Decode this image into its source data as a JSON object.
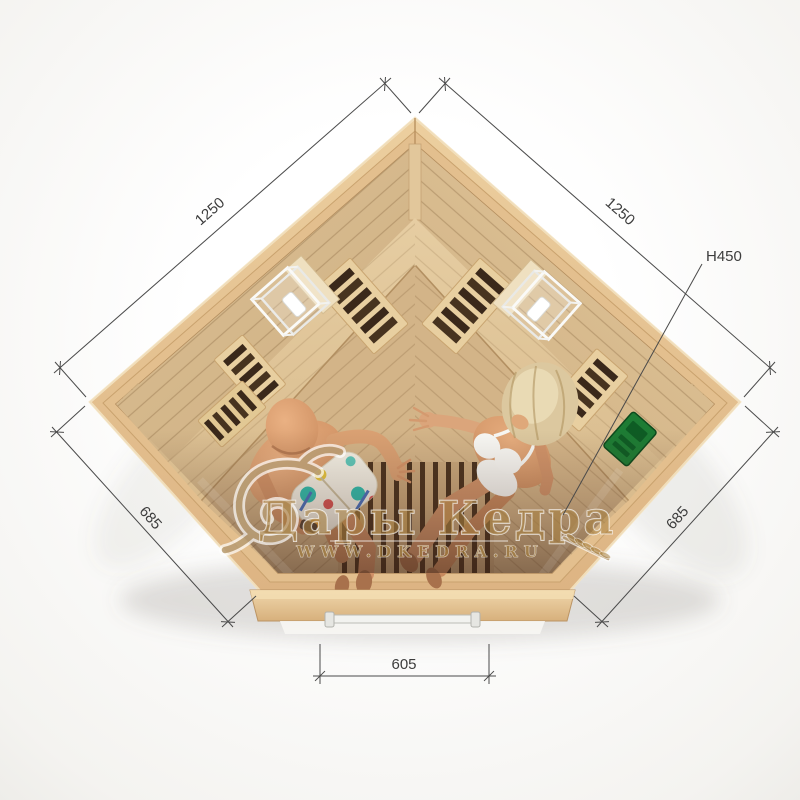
{
  "watermark": {
    "brand": "Дары Кедра",
    "website": "WWW.DKEDRA.RU",
    "ornament_icon": "cedar-flourish",
    "wheat_icon": "wheat-sprig",
    "gold_color": "#a8813f"
  },
  "dimensions": {
    "left_wall": "1250",
    "right_wall": "1250",
    "left_side": "685",
    "right_side": "685",
    "door_width": "605",
    "bench_height": "H450"
  },
  "scene": {
    "description_items": {
      "people_count": "2",
      "lamps": "2"
    },
    "colors": {
      "background": "#f3f2f0",
      "wood_frame": "#e7c594",
      "wood_interior": "#d8bc8e",
      "wood_floor": "#d3b488",
      "glass_tint": "#3c241a",
      "control_panel_green": "#1d7c34",
      "dimension_line": "#4a4a4a"
    }
  }
}
